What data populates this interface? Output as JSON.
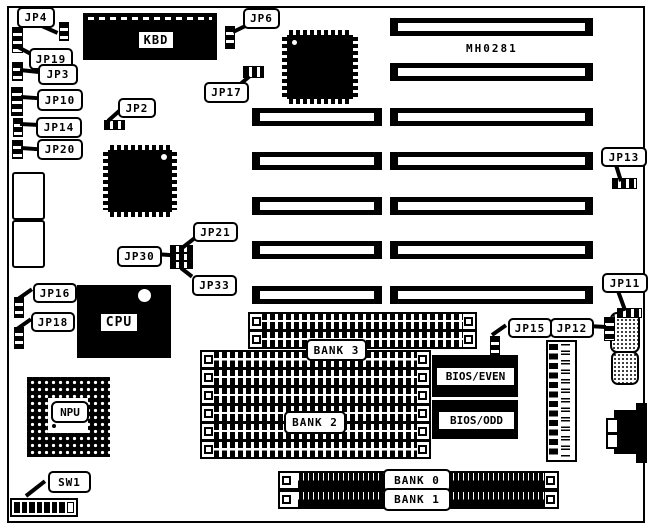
{
  "board": {
    "part_number": "MH0281"
  },
  "chips": {
    "kbd": "KBD",
    "cpu": "CPU",
    "npu": "NPU",
    "bios_even": "BIOS/EVEN",
    "bios_odd": "BIOS/ODD"
  },
  "jumpers": {
    "jp2": "JP2",
    "jp3": "JP3",
    "jp4": "JP4",
    "jp6": "JP6",
    "jp10": "JP10",
    "jp11": "JP11",
    "jp12": "JP12",
    "jp13": "JP13",
    "jp14": "JP14",
    "jp15": "JP15",
    "jp16": "JP16",
    "jp17": "JP17",
    "jp18": "JP18",
    "jp19": "JP19",
    "jp20": "JP20",
    "jp21": "JP21",
    "jp30": "JP30",
    "jp33": "JP33"
  },
  "switches": {
    "sw1": "SW1"
  },
  "memory_banks": {
    "bank0": "BANK 0",
    "bank1": "BANK 1",
    "bank2": "BANK 2",
    "bank3": "BANK 3"
  },
  "colors": {
    "foreground": "#000000",
    "background": "#ffffff"
  }
}
